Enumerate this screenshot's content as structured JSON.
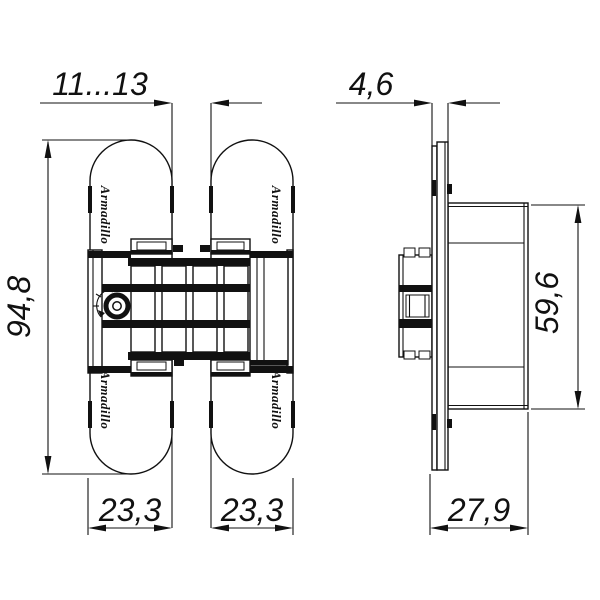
{
  "brand": "Armadillo",
  "colors": {
    "line": "#111111",
    "background": "#ffffff"
  },
  "dimensions": {
    "door_gap": "11...13",
    "plate_thickness": "4,6",
    "overall_height": "94,8",
    "body_height": "59,6",
    "left_plate_width": "23,3",
    "right_plate_width": "23,3",
    "body_depth": "27,9"
  }
}
